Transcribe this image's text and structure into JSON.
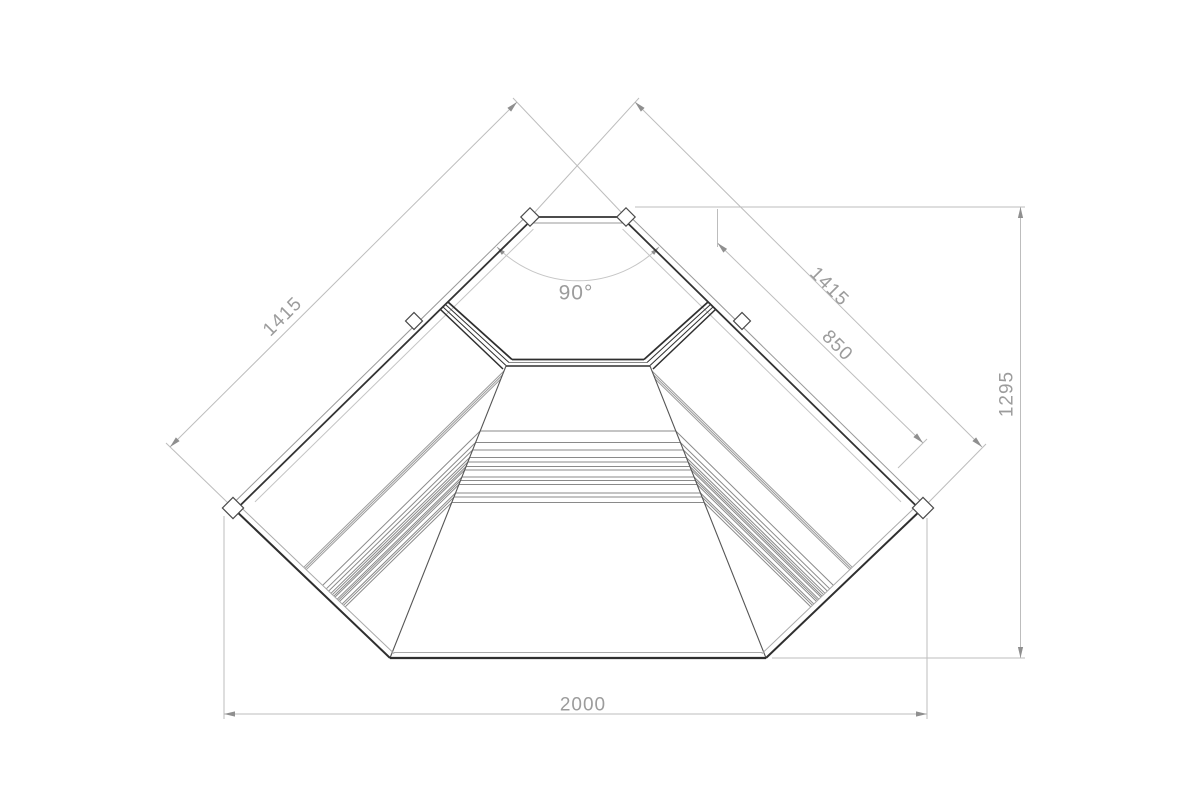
{
  "dimensions": {
    "left_arm": "1415",
    "right_arm": "1415",
    "right_inner": "850",
    "side_depth": "1295",
    "front_width": "2000",
    "corner_angle": "90°"
  },
  "colors": {
    "background": "#ffffff",
    "outline_dark": "#2f2f2f",
    "wall_medium": "#333333",
    "band_gray": "#999999",
    "step_line": "#8a8a8a",
    "mitre_line": "#555555",
    "faint_line": "#c4c4c4",
    "dimension_line": "#bdbdbd",
    "arc_line": "#c6c6c6",
    "arrow": "#8f8f8f",
    "dimension_text": "#9c9c9c"
  }
}
